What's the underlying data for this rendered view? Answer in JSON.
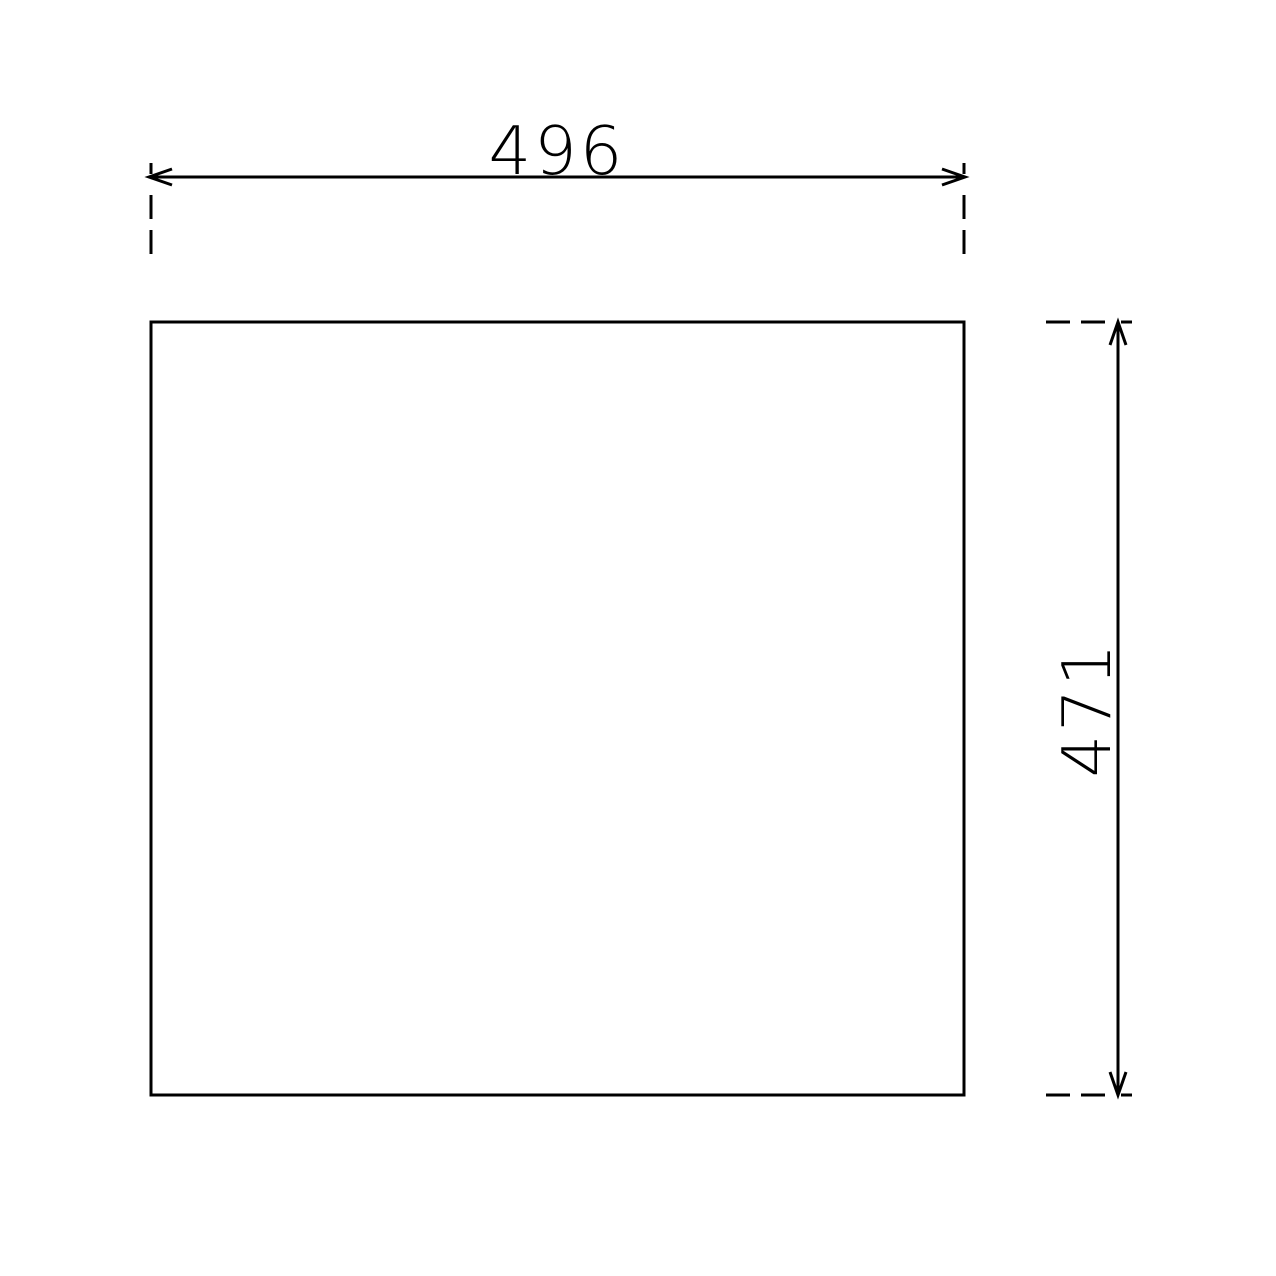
{
  "drawing": {
    "type": "technical-dimension-drawing",
    "part": {
      "shape": "rectangle"
    },
    "horizontal_dimension": {
      "label": "496"
    },
    "vertical_dimension": {
      "label": "471"
    },
    "colors": {
      "line": "#000000",
      "background": "#ffffff"
    }
  }
}
